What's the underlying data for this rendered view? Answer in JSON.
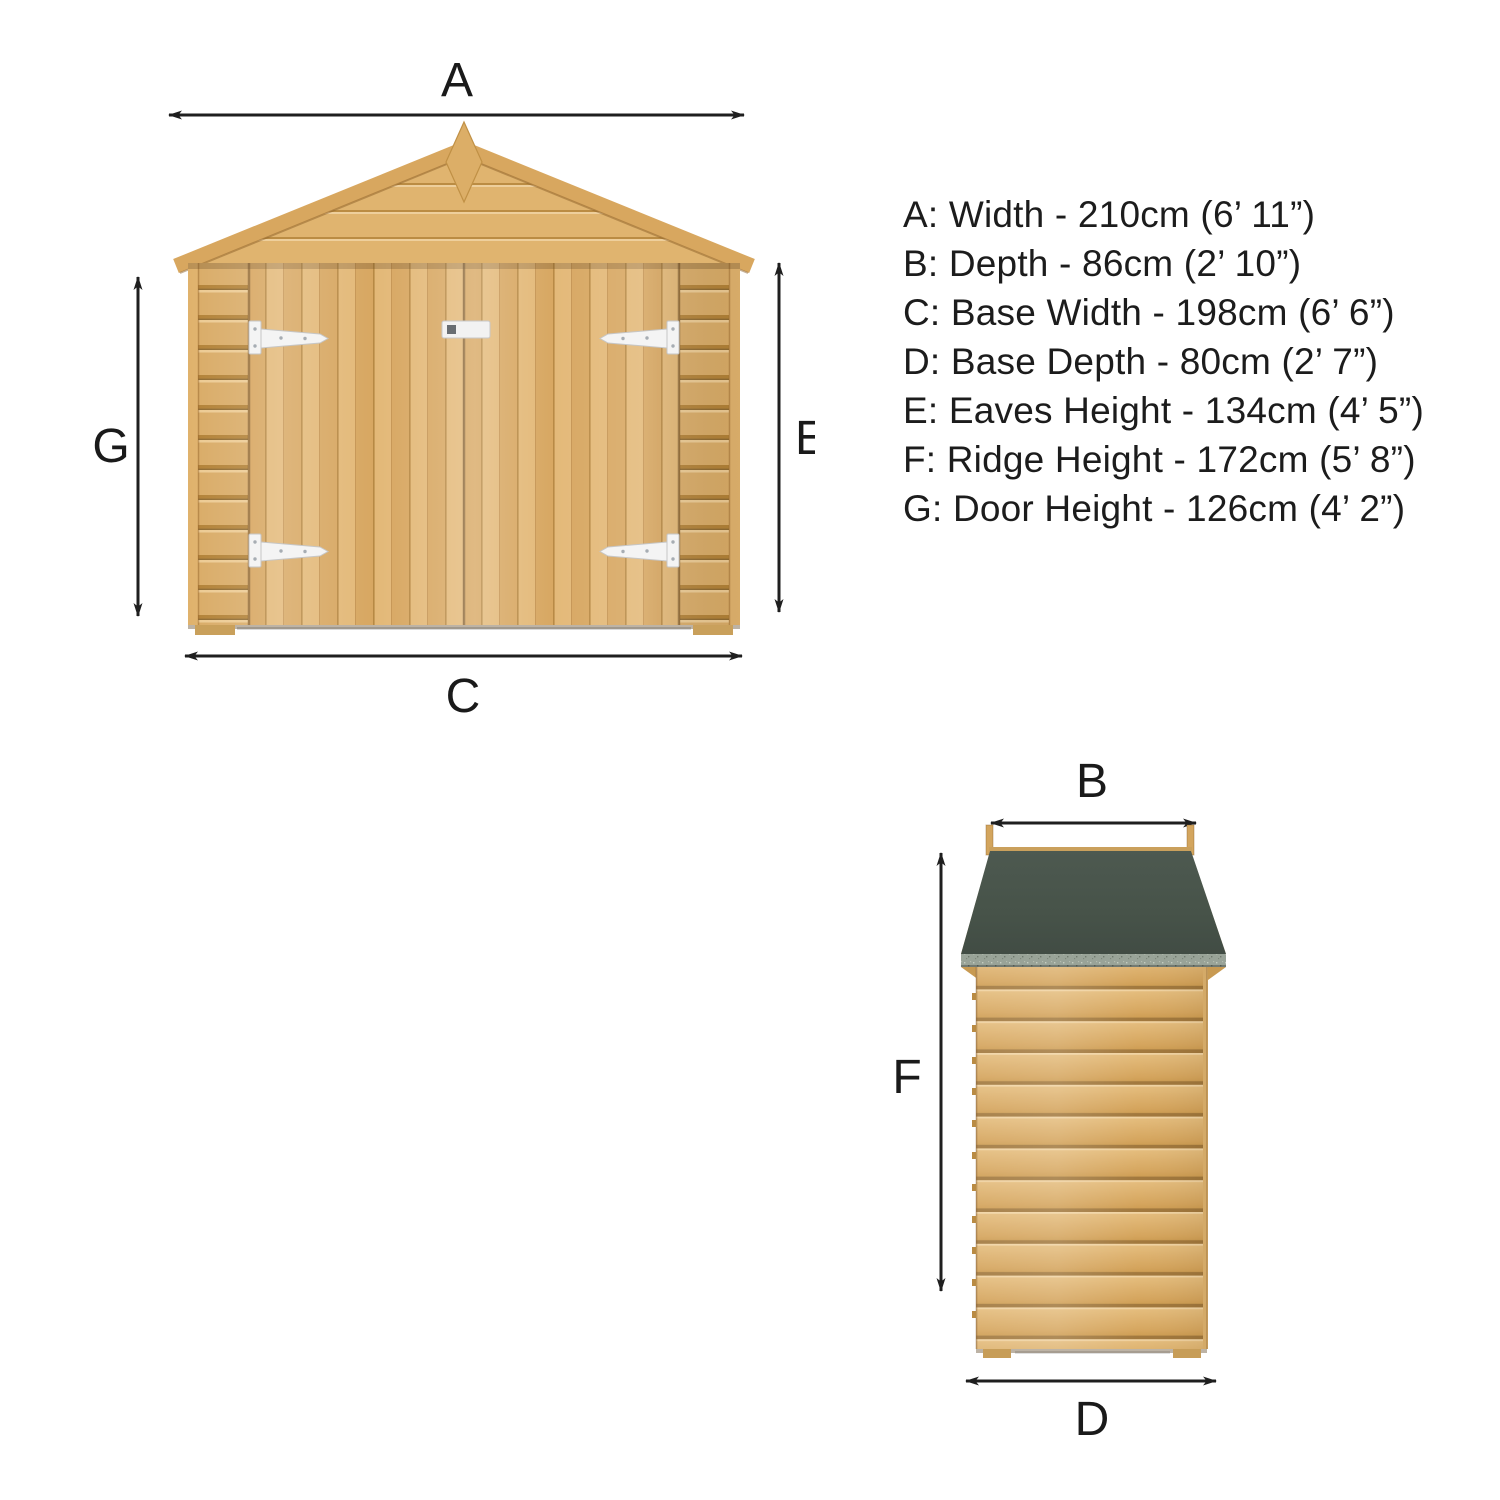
{
  "diagram_title": "Shed dimension diagram",
  "front_view": {
    "name": "front-elevation",
    "labels": {
      "width": "A",
      "door_height": "G",
      "eaves_height": "E",
      "base_width": "C"
    }
  },
  "side_view": {
    "name": "side-elevation",
    "labels": {
      "depth": "B",
      "ridge_height": "F",
      "base_depth": "D"
    }
  },
  "specs": {
    "lines": [
      "A: Width - 210cm (6’ 11”)",
      "B: Depth - 86cm (2’ 10”)",
      "C: Base Width - 198cm (6’ 6”)",
      "D: Base Depth - 80cm (2’ 7”)",
      "E: Eaves Height - 134cm (4’ 5”)",
      "F: Ridge Height - 172cm (5’ 8”)",
      "G: Door Height - 126cm (4’ 2”)"
    ]
  },
  "colors": {
    "background": "#ffffff",
    "arrow": "#1f1f1f",
    "text": "#1c1c1c",
    "wood_light": "#e6c386",
    "wood_mid": "#d9ab66",
    "wood_dark": "#a5793a",
    "roof_felt": "#4a554c",
    "roof_felt_edge": "#99a398",
    "hardware_white": "#f3f3f3"
  }
}
